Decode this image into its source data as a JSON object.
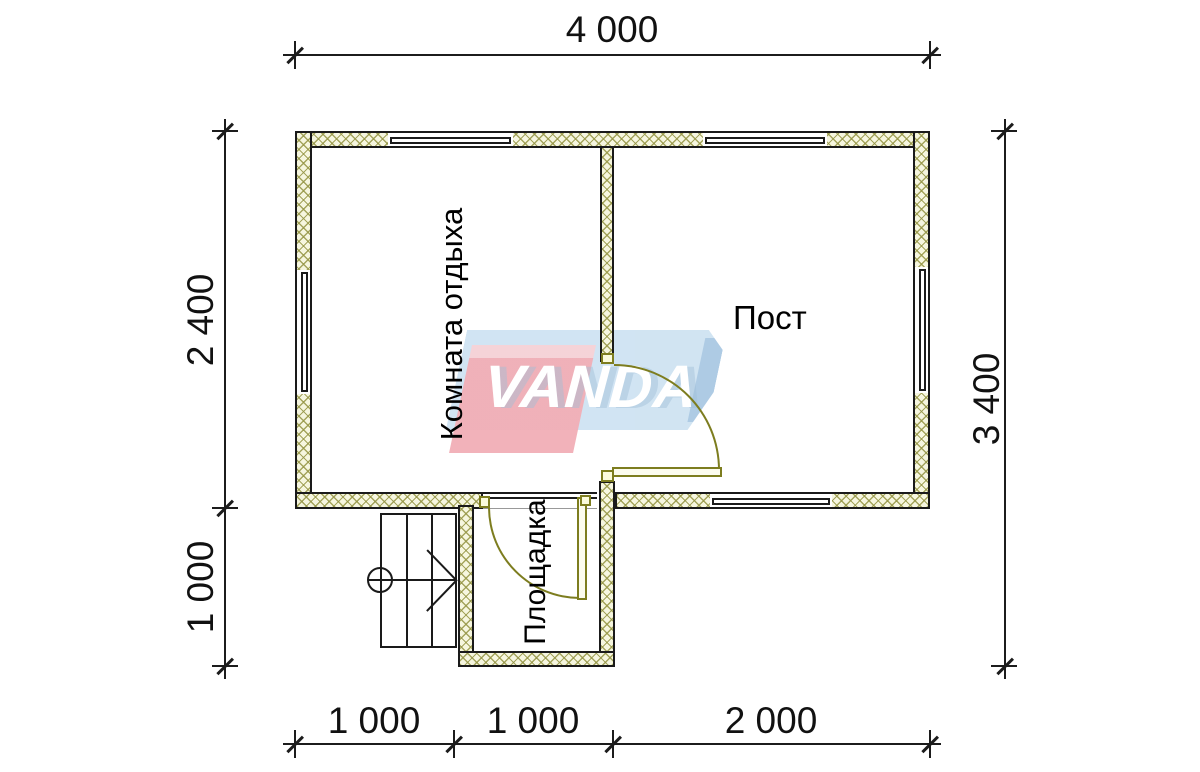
{
  "watermark": {
    "brand": "VANDA"
  },
  "rooms": {
    "rest_room": {
      "label": "Комната отдыха"
    },
    "post_room": {
      "label": "Пост"
    },
    "porch": {
      "label": "Площадка"
    }
  },
  "dimensions": {
    "top": [
      {
        "label": "4 000"
      }
    ],
    "bottom": [
      {
        "label": "1 000"
      },
      {
        "label": "1 000"
      },
      {
        "label": "2 000"
      }
    ],
    "left": [
      {
        "label": "2 400"
      },
      {
        "label": "1 000"
      }
    ],
    "right": [
      {
        "label": "3 400"
      }
    ]
  },
  "colors": {
    "wall_fill": "#f6f6df",
    "wall_hatch": "#96964 6",
    "outline": "#1a1a1a",
    "door": "#7d7d1f",
    "logo_blue": "#cfe3f2",
    "logo_blue_dark": "#aac9e3",
    "logo_red": "#f1aeb6",
    "logo_text_color": "#ffffff"
  }
}
